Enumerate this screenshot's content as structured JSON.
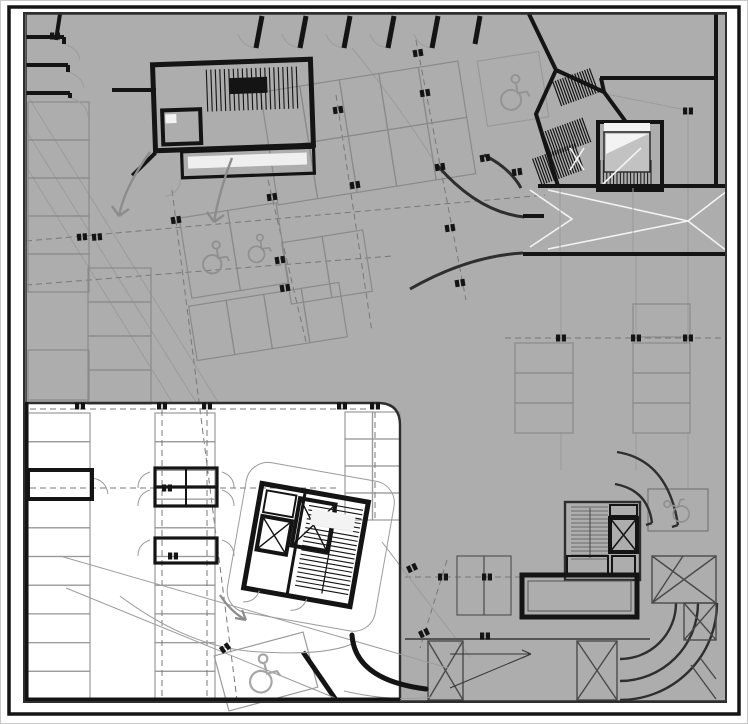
{
  "drawing": {
    "kind": "architectural-floor-plan",
    "subject": "underground-parking-level",
    "text_labels": []
  },
  "palette": {
    "background": "#ffffff",
    "slab": "#adadad",
    "slab_shadow": "#b5b5b5",
    "ink": "#141414",
    "wall_dark": "#2e2e2e",
    "line_dark": "#4a4a4a",
    "line_mid": "#8a8a8a",
    "line_light": "#9c9c9c",
    "dash": "#787878",
    "white_marking": "#f3f3f3",
    "stair_fill": "#c2c2c2",
    "inner_white": "#efefef"
  },
  "parking_groups": [
    {
      "id": "north-double-row",
      "x": 268,
      "y": 76,
      "cols": 5,
      "rows": 2,
      "cw": 40,
      "ch": 57,
      "a": -9,
      "color": "#8a8a8a"
    },
    {
      "id": "accessible-pair-upper-left",
      "x": 185,
      "y": 210,
      "cols": 2,
      "rows": 1,
      "cw": 49,
      "ch": 81,
      "a": -9,
      "color": "#8a8a8a"
    },
    {
      "id": "mid-left-row",
      "x": 192,
      "y": 294,
      "cols": 4,
      "rows": 1,
      "cw": 38,
      "ch": 55,
      "a": -9,
      "color": "#8a8a8a"
    },
    {
      "id": "mid-center-pair",
      "x": 286,
      "y": 236,
      "cols": 2,
      "rows": 1,
      "cw": 41,
      "ch": 62,
      "a": -9,
      "color": "#8a8a8a"
    },
    {
      "id": "west-edge-column-upper",
      "x": 28,
      "y": 102,
      "cols": 1,
      "rows": 5,
      "cw": 61,
      "ch": 38,
      "a": 0,
      "color": "#8a8a8a"
    },
    {
      "id": "west-edge-single",
      "x": 28,
      "y": 350,
      "cols": 1,
      "rows": 1,
      "cw": 61,
      "ch": 50,
      "a": 0,
      "color": "#8a8a8a"
    },
    {
      "id": "west-second-column",
      "x": 88,
      "y": 268,
      "cols": 1,
      "rows": 4,
      "cw": 63,
      "ch": 34,
      "a": 0,
      "color": "#8a8a8a"
    },
    {
      "id": "east-upper-single",
      "x": 633,
      "y": 304,
      "cols": 1,
      "rows": 1,
      "cw": 57,
      "ch": 33,
      "a": 0,
      "color": "#8a8a8a"
    },
    {
      "id": "east-stack-a",
      "x": 515,
      "y": 343,
      "cols": 1,
      "rows": 3,
      "cw": 58,
      "ch": 30,
      "a": 0,
      "color": "#8a8a8a"
    },
    {
      "id": "east-stack-b",
      "x": 633,
      "y": 343,
      "cols": 1,
      "rows": 3,
      "cw": 57,
      "ch": 30,
      "a": 0,
      "color": "#8a8a8a"
    },
    {
      "id": "south-center-pair",
      "x": 457,
      "y": 556,
      "cols": 2,
      "rows": 1,
      "cw": 27,
      "ch": 59,
      "a": 0,
      "color": "#555555"
    },
    {
      "id": "accessible-single-northeast",
      "x": 482,
      "y": 56,
      "cols": 1,
      "rows": 1,
      "cw": 62,
      "ch": 66,
      "a": -9,
      "color": "#999999"
    },
    {
      "id": "accessible-single-southeast",
      "x": 648,
      "y": 489,
      "cols": 1,
      "rows": 1,
      "cw": 60,
      "ch": 42,
      "a": 0,
      "color": "#777777"
    },
    {
      "id": "white-area-west-column",
      "x": 28,
      "y": 413,
      "cols": 1,
      "rows": 10,
      "cw": 62,
      "ch": 28.7,
      "a": 0,
      "color": "#9a9a9a"
    },
    {
      "id": "white-area-mid-column",
      "x": 155,
      "y": 413,
      "cols": 1,
      "rows": 10,
      "cw": 60,
      "ch": 28.7,
      "a": 0,
      "color": "#9a9a9a"
    },
    {
      "id": "white-area-east-grid",
      "x": 345,
      "y": 412,
      "cols": 2,
      "rows": 4,
      "cw": 27.5,
      "ch": 27,
      "a": 0,
      "color": "#9a9a9a"
    },
    {
      "id": "accessible-single-southwest",
      "x": 220,
      "y": 643,
      "cols": 1,
      "rows": 1,
      "cw": 92,
      "ch": 57,
      "a": -15,
      "color": "#9a9a9a"
    }
  ],
  "column_markers": [
    [
      55,
      36,
      0
    ],
    [
      82,
      237,
      -5
    ],
    [
      97,
      237,
      -5
    ],
    [
      176,
      220,
      -9
    ],
    [
      272,
      197,
      -9
    ],
    [
      280,
      260,
      -9
    ],
    [
      285,
      288,
      -9
    ],
    [
      338,
      110,
      -9
    ],
    [
      355,
      185,
      -9
    ],
    [
      418,
      53,
      -9
    ],
    [
      425,
      93,
      -9
    ],
    [
      440,
      167,
      -9
    ],
    [
      450,
      228,
      -9
    ],
    [
      460,
      283,
      -9
    ],
    [
      485,
      158,
      -9
    ],
    [
      517,
      172,
      -9
    ],
    [
      688,
      111,
      0
    ],
    [
      561,
      338,
      0
    ],
    [
      636,
      338,
      0
    ],
    [
      688,
      338,
      0
    ],
    [
      443,
      577,
      0
    ],
    [
      487,
      577,
      0
    ],
    [
      424,
      633,
      -25
    ],
    [
      485,
      636,
      0
    ],
    [
      412,
      568,
      -25
    ],
    [
      80,
      406,
      0
    ],
    [
      162,
      406,
      0
    ],
    [
      207,
      406,
      0
    ],
    [
      342,
      406,
      0
    ],
    [
      375,
      406,
      0
    ],
    [
      167,
      488,
      0
    ],
    [
      173,
      556,
      0
    ],
    [
      225,
      648,
      -35
    ]
  ],
  "wheelchair_symbols": [
    {
      "x": 214,
      "y": 257,
      "a": -9,
      "s": 1.15,
      "c": "#8f8f8f"
    },
    {
      "x": 258,
      "y": 248,
      "a": -9,
      "s": 1.0,
      "c": "#8f8f8f"
    },
    {
      "x": 513,
      "y": 92,
      "a": -9,
      "s": 1.25,
      "c": "#949494"
    },
    {
      "x": 676,
      "y": 510,
      "a": -75,
      "s": 1.0,
      "c": "#8f8f8f"
    },
    {
      "x": 262,
      "y": 673,
      "a": -15,
      "s": 1.35,
      "c": "#a5a5a5"
    }
  ],
  "tread_hatches": [
    {
      "id": "stair-nw",
      "x": 207,
      "y": 68,
      "w": 94,
      "h": 42,
      "dir": "v",
      "step": 4.5,
      "a": -2,
      "color": "#141414",
      "lw": 1.1
    },
    {
      "id": "hatch-ne-1",
      "x": 556,
      "y": 74,
      "w": 40,
      "h": 26,
      "dir": "v",
      "step": 2.6,
      "a": -20,
      "color": "#141414",
      "lw": 1.2
    },
    {
      "id": "hatch-ne-2",
      "x": 546,
      "y": 124,
      "w": 42,
      "h": 26,
      "dir": "v",
      "step": 2.6,
      "a": -20,
      "color": "#141414",
      "lw": 1.2
    },
    {
      "id": "hatch-ne-3",
      "x": 536,
      "y": 150,
      "w": 46,
      "h": 28,
      "dir": "v",
      "step": 2.6,
      "a": -20,
      "color": "#141414",
      "lw": 1.2
    },
    {
      "id": "stair-ne",
      "x": 600,
      "y": 160,
      "w": 54,
      "h": 28,
      "dir": "v",
      "step": 3.4,
      "a": 0,
      "color": "#141414",
      "lw": 1.0
    },
    {
      "id": "stair-se",
      "x": 571,
      "y": 507,
      "w": 37,
      "h": 52,
      "dir": "h",
      "step": 4,
      "a": 0,
      "color": "#6a6a6a",
      "lw": 1.0
    },
    {
      "id": "stair-sw",
      "x": 302,
      "y": 505,
      "w": 54,
      "h": 86,
      "dir": "h",
      "step": 4.5,
      "a": 10,
      "color": "#141414",
      "lw": 1.1
    }
  ],
  "flow_arrows": [
    {
      "id": "drive-arrow-left",
      "d": "M150,152 Q124,188 119,216 M119,216 l-7,-10 M119,216 l10,-7",
      "c": "#8c8c8c",
      "w": 2.4
    },
    {
      "id": "drive-arrow-right",
      "d": "M232,158 Q219,192 214,222 M214,222 l-7,-10 M214,222 l10,-7",
      "c": "#8c8c8c",
      "w": 2.4
    },
    {
      "id": "drive-arrow-white-area",
      "d": "M220,595 Q231,612 246,620 M246,620 l-11,-2 M246,620 l-4,-10",
      "c": "#8c8c8c",
      "w": 2.2
    }
  ]
}
